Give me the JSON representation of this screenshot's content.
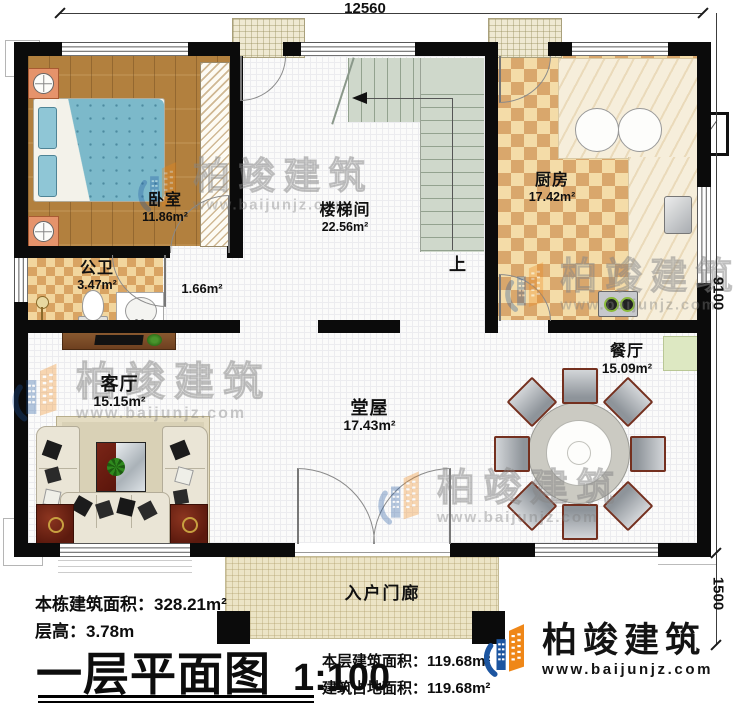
{
  "meta": {
    "drawing_type": "floor-plan"
  },
  "title_block": {
    "title": "一层平面图",
    "scale": "1:100",
    "total_area_label": "本栋建筑面积：",
    "total_area_value": "328.21m²",
    "floor_height_label": "层高：",
    "floor_height_value": "3.78m",
    "floor_area_label": "本层建筑面积：",
    "floor_area_value": "119.68m²",
    "footprint_label": "建筑占地面积：",
    "footprint_value": "119.68m²"
  },
  "brand": {
    "name": "柏竣建筑",
    "url": "www.baijunjz.com"
  },
  "watermark": {
    "name": "柏竣建筑",
    "url": "www.baijunjz.com"
  },
  "dimensions": {
    "top_width": "12560",
    "right_height": "9100",
    "porch_depth": "1500"
  },
  "rooms": {
    "bedroom": {
      "name": "卧室",
      "area": "11.86m²"
    },
    "stairwell": {
      "name": "楼梯间",
      "area": "22.56m²"
    },
    "kitchen": {
      "name": "厨房",
      "area": "17.42m²"
    },
    "bathroom": {
      "name": "公卫",
      "area": "3.47m²"
    },
    "corridor": {
      "area": "1.66m²"
    },
    "living": {
      "name": "客厅",
      "area": "15.15m²"
    },
    "hall": {
      "name": "堂屋",
      "area": "17.43m²"
    },
    "dining": {
      "name": "餐厅",
      "area": "15.09m²"
    },
    "porch": {
      "name": "入户门廊"
    }
  },
  "stairs": {
    "up_label": "上"
  },
  "colors": {
    "wall": "#0b0b0b",
    "wood_floor": "#b2803e",
    "tile_light": "#f4dca8",
    "tile_dark": "#d9a76c",
    "stair": "#cfd8cb",
    "porch": "#ece4c6",
    "brand_blue": "#1c55a0",
    "brand_orange": "#ef8718"
  }
}
